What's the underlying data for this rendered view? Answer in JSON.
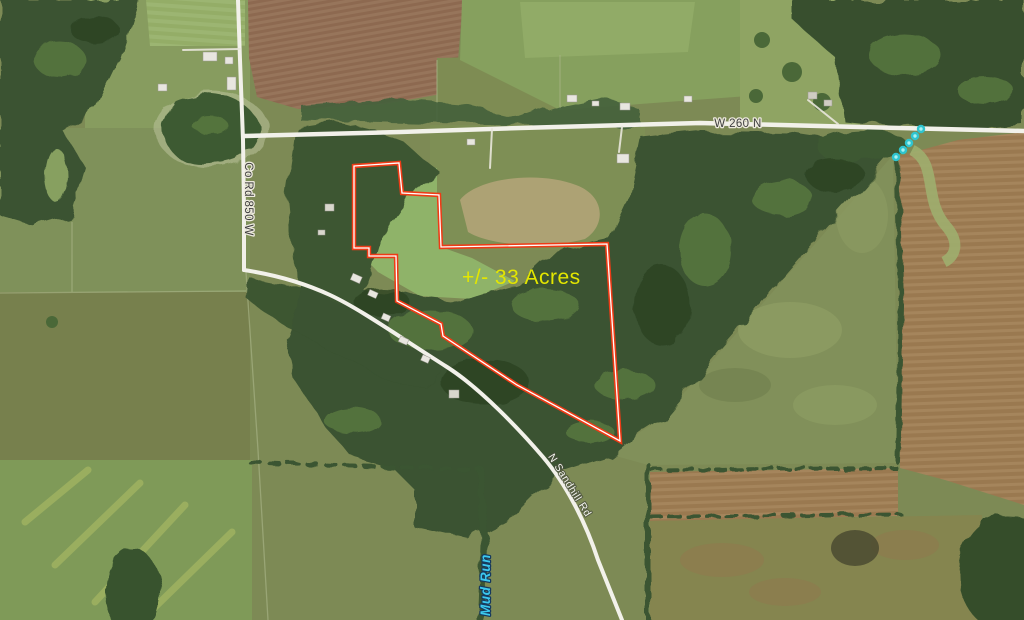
{
  "map": {
    "acreage": {
      "label": "+/- 33 Acres",
      "color": "#e3e600"
    },
    "roads": {
      "top": {
        "label": "W 260 N"
      },
      "left": {
        "label": "Co Rd 850 W"
      },
      "diagonal": {
        "label": "N Sandhill Rd"
      }
    },
    "stream": {
      "label": "Mud Run",
      "color": "#3cc9ef"
    },
    "boundary": {
      "color": "#ee3b16",
      "core_color": "#ffffff"
    },
    "stream_dots_color": "#2fc4cf"
  }
}
